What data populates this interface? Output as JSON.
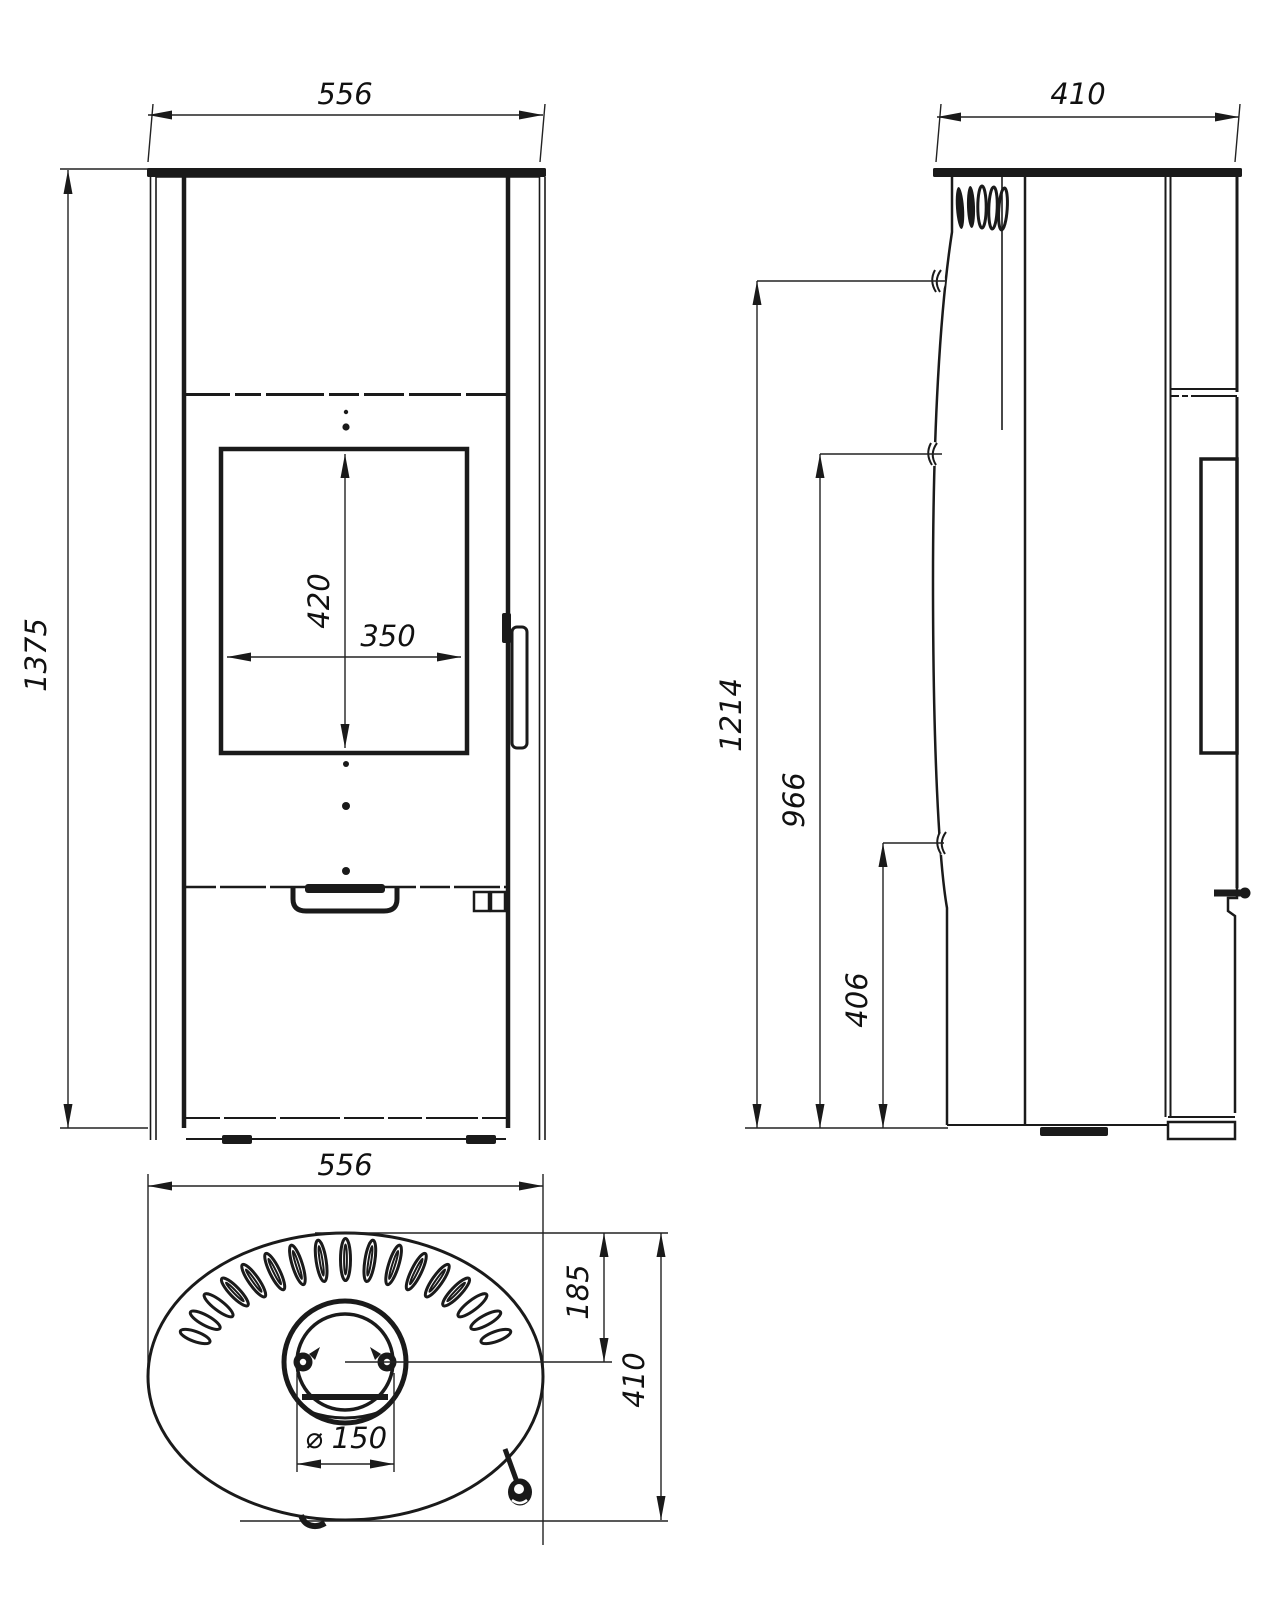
{
  "background": "#ffffff",
  "ink": "#1a1a1a",
  "views": {
    "front": {
      "width_mm": "556",
      "height_mm": "1375",
      "glass_height_mm": "420",
      "glass_width_mm": "350"
    },
    "side": {
      "depth_mm": "410",
      "upper_connection_height_mm": "1214",
      "rear_connection_height_mm": "966",
      "lower_connection_height_mm": "406"
    },
    "top": {
      "width_mm": "556",
      "flue_centre_from_rear_mm": "185",
      "depth_mm": "410",
      "flue_diameter_mm": "⌀ 150"
    }
  }
}
